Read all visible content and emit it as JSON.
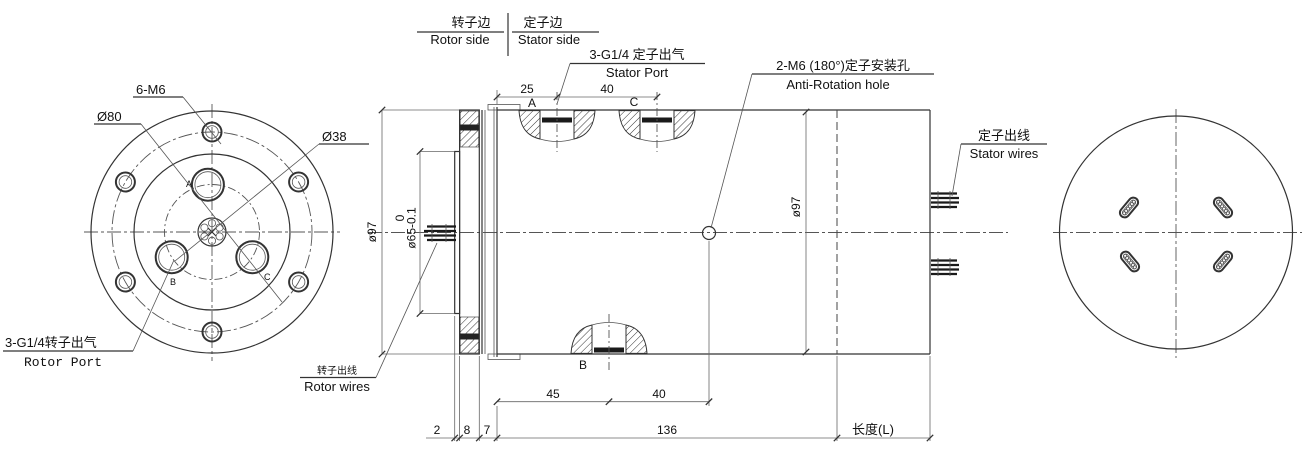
{
  "header": {
    "rotor_side_cn": "转子边",
    "rotor_side_en": "Rotor side",
    "stator_side_cn": "定子边",
    "stator_side_en": "Stator side"
  },
  "front_view": {
    "bolt_label": "6-M6",
    "bolt_circle_dia": "Ø80",
    "port_circle_dia": "Ø38",
    "rotor_port_cn": "3-G1/4转子出气",
    "rotor_port_en": "Rotor Port",
    "port_a": "A",
    "port_b": "B",
    "port_c": "C"
  },
  "section_view": {
    "stator_port_cn": "3-G1/4 定子出气",
    "stator_port_en": "Stator Port",
    "anti_rotation_cn": "2-M6 (180°)定子安装孔",
    "anti_rotation_en": "Anti-Rotation hole",
    "rotor_wires_cn": "转子出线",
    "rotor_wires_en": "Rotor wires",
    "stator_wires_cn": "定子出线",
    "stator_wires_en": "Stator wires",
    "flange_dia": "ø97",
    "body_dia": "ø97",
    "spigot_tol_upper": "0",
    "spigot_dia": "ø65-0.1",
    "port_a": "A",
    "port_b": "B",
    "port_c": "C"
  },
  "dims": {
    "top_25": "25",
    "top_40": "40",
    "bottom_45": "45",
    "bottom_40": "40",
    "spigot_t": "2",
    "flange_t": "8",
    "gap": "7",
    "body_len": "136",
    "ext_len": "长度(L)"
  }
}
